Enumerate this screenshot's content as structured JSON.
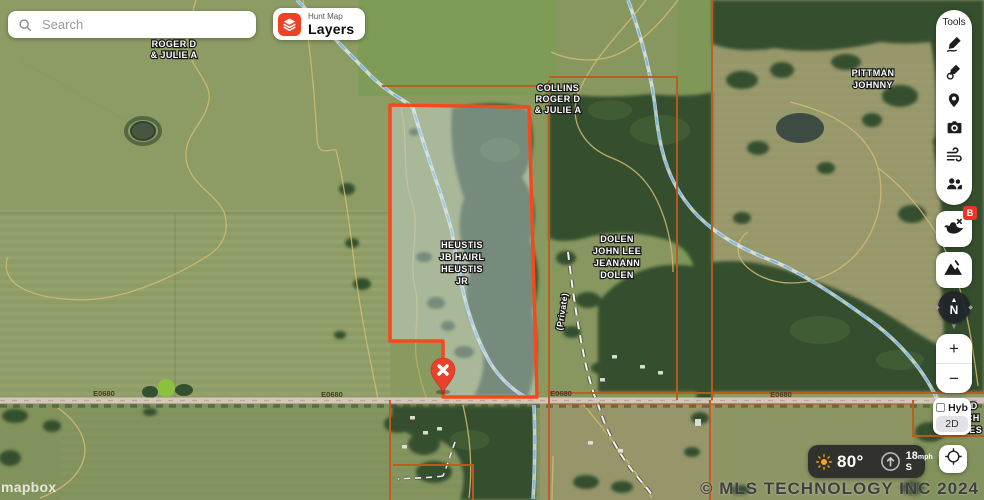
{
  "search": {
    "placeholder": "Search"
  },
  "layers_button": {
    "eyebrow": "Hunt Map",
    "label": "Layers"
  },
  "tools": {
    "title": "Tools",
    "icons": [
      "draw-line",
      "draw-area",
      "drop-pin",
      "camera",
      "wind",
      "members"
    ]
  },
  "side_buttons": {
    "waterfowl_badge": "B"
  },
  "compass": {
    "label": "N"
  },
  "zoom": {
    "in": "+",
    "out": "−"
  },
  "map_type": {
    "primary": "Hyb",
    "secondary": "2D"
  },
  "weather": {
    "temp": "80°",
    "wind_speed": "18",
    "wind_unit": "mph",
    "wind_dir": "S"
  },
  "map": {
    "labels": {
      "roger": [
        "ROGER D",
        "& JULIE A"
      ],
      "collins": [
        "COLLINS",
        "ROGER D",
        "& JULIE A"
      ],
      "pittman": [
        "PITTMAN",
        "JOHNNY"
      ],
      "dolen": [
        "DOLEN",
        "JOHN LEE",
        "JEANANN",
        "DOLEN"
      ],
      "heustis": [
        "HEUSTIS",
        "JB HAIRL",
        "HEUSTIS",
        "JR"
      ],
      "edge_partial": [
        "IRD",
        "RCH",
        "TEES"
      ],
      "private_road": "(Private)"
    },
    "road_labels": [
      "E0680",
      "E0680",
      "E0680",
      "E0680"
    ]
  },
  "footer": {
    "copyright": "© MLS TECHNOLOGY INC 2024",
    "attribution": "mapbox"
  },
  "colors": {
    "accent_red": "#f04124",
    "highlight_stroke": "#f5491d",
    "parcel_line": "#bf5a1e",
    "stream": "#7db7e2",
    "pin": "#e8412c"
  }
}
